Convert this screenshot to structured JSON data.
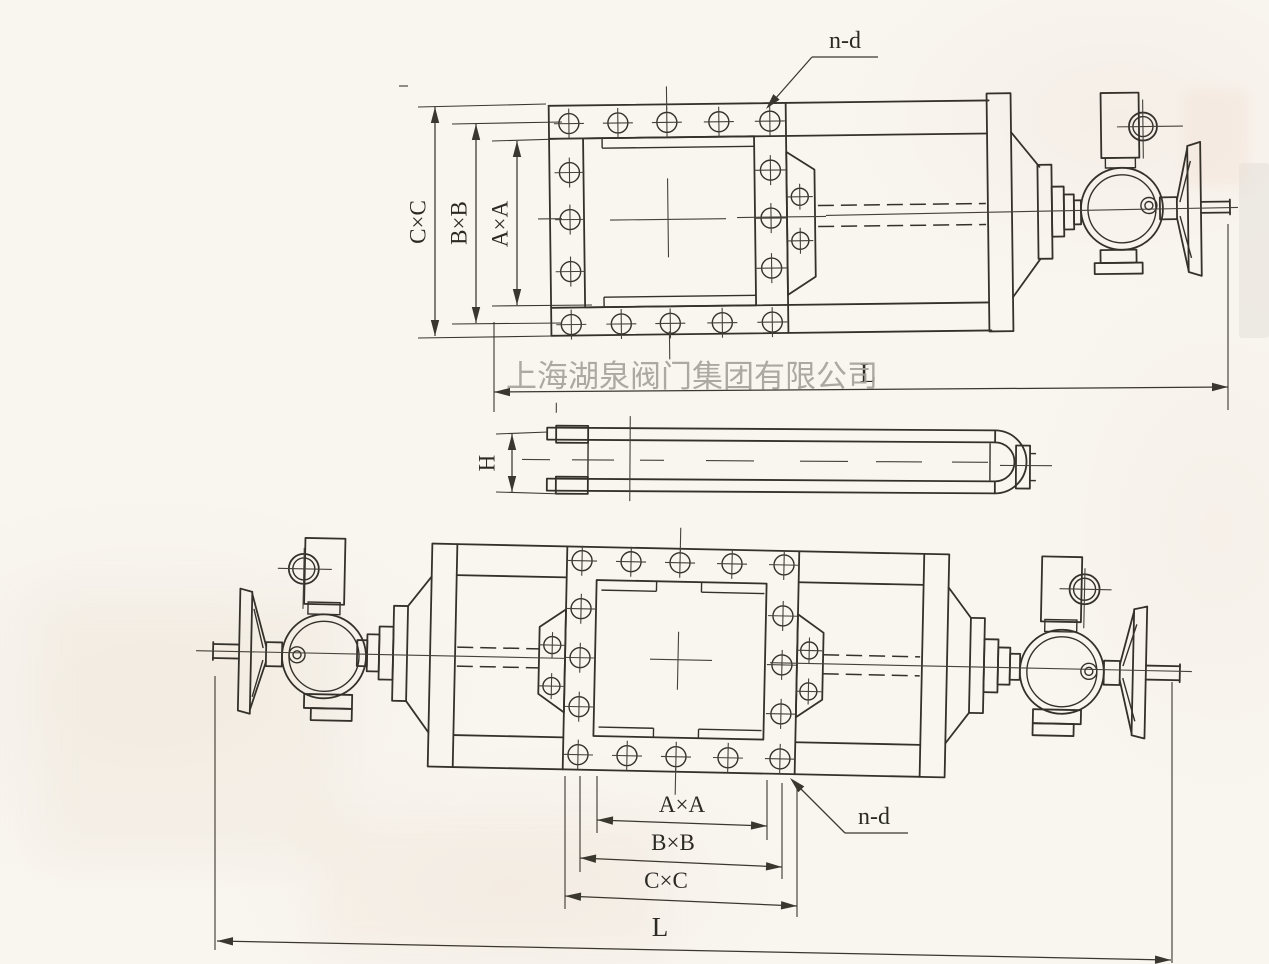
{
  "drawing": {
    "watermark": "上海湖泉阀门集团有限公司",
    "top_view": {
      "dim_outer": "C×C",
      "dim_bolt": "B×B",
      "dim_inner": "A×A",
      "bolt_hole_note": "n-d",
      "dim_length": "L"
    },
    "side_view": {
      "dim_height": "H"
    },
    "bottom_view": {
      "dim_inner": "A×A",
      "dim_bolt": "B×B",
      "dim_outer": "C×C",
      "bolt_hole_note": "n-d",
      "dim_length": "L"
    }
  },
  "colors": {
    "line": "#34312b",
    "dimension": "#3a372f",
    "watermark": "#a6a29c",
    "paper": "#f9f6f0"
  }
}
